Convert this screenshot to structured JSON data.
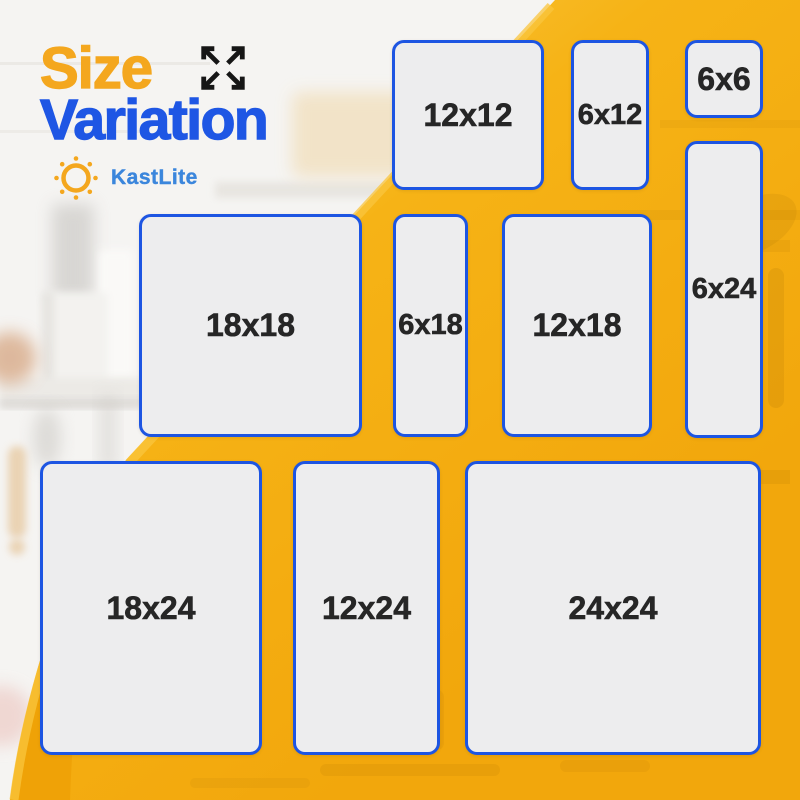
{
  "header": {
    "title_line1": "Size",
    "title_line2": "Variation",
    "brand": "KastLite"
  },
  "panels": [
    {
      "label": "12x12"
    },
    {
      "label": "6x12"
    },
    {
      "label": "6x6"
    },
    {
      "label": "6x24"
    },
    {
      "label": "18x18"
    },
    {
      "label": "6x18"
    },
    {
      "label": "12x18"
    },
    {
      "label": "18x24"
    },
    {
      "label": "12x24"
    },
    {
      "label": "24x24"
    }
  ],
  "icons": {
    "expand_arrows": "expand-arrows-icon",
    "sun": "sun-icon"
  },
  "colors": {
    "yellow": "#f6b316",
    "yellow_light_edge": "#f9c63e",
    "yellow_mid": "#f8bd2b",
    "yellow_deep": "#f2a70c",
    "orange_wedge": "#ee9f04",
    "panel_fill": "#ededee",
    "panel_border": "#1d55e2",
    "label_text": "#262626",
    "title_orange": "#f4a71e",
    "title_blue": "#1e56e4",
    "brand_blue": "#3b86dc",
    "icon_black": "#161616",
    "photo_wall": "#f5f4f2"
  }
}
